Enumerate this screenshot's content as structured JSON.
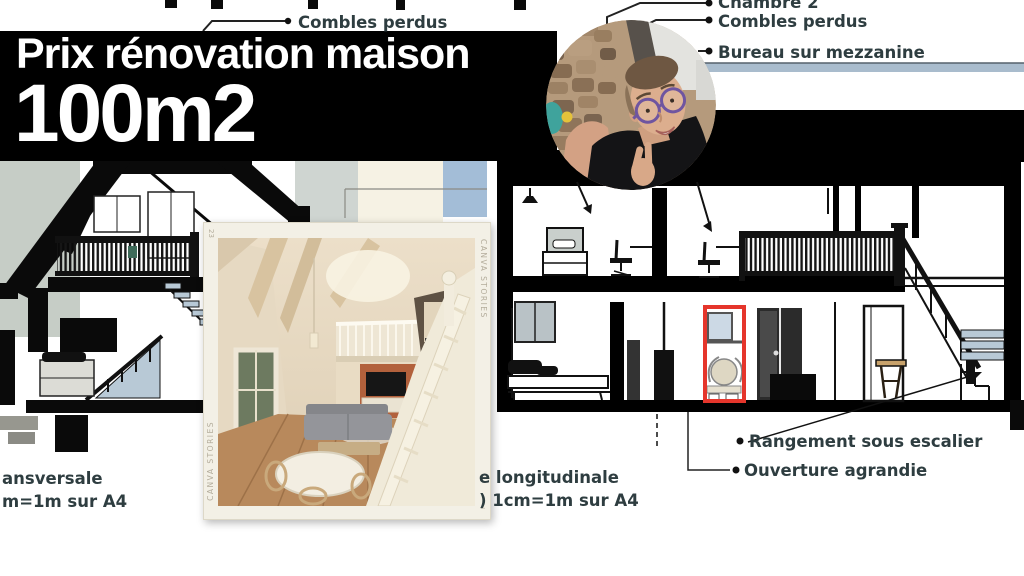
{
  "banner": {
    "title": "Prix rénovation maison",
    "subtitle": "100m2"
  },
  "annotations": {
    "combles_left": "Combles perdus",
    "chambre2": "Chambre 2",
    "combles_right": "Combles perdus",
    "bureau": "Bureau sur mezzanine",
    "rangement": "Rangement sous escalier",
    "ouverture": "Ouverture agrandie"
  },
  "captions": {
    "left_line1": "ansversale",
    "left_line2": "m=1m sur A4",
    "center_line1": "e longitudinale",
    "center_line2": ") 1cm=1m sur A4"
  },
  "watermark": {
    "brand": "CANVA STORIES",
    "number": "23",
    "triangle": "▵"
  },
  "colors": {
    "banner_bg": "#000000",
    "banner_text": "#ffffff",
    "label_text": "#2e3d40",
    "highlight_red": "#e5352b",
    "stair_tread_blue": "#b8c9d6",
    "page_sage": "#c6cdc6",
    "page_cream": "#f6f2e4",
    "accent_bar_blue": "#a9bccd",
    "inset_frame": "#f3f0e6"
  }
}
